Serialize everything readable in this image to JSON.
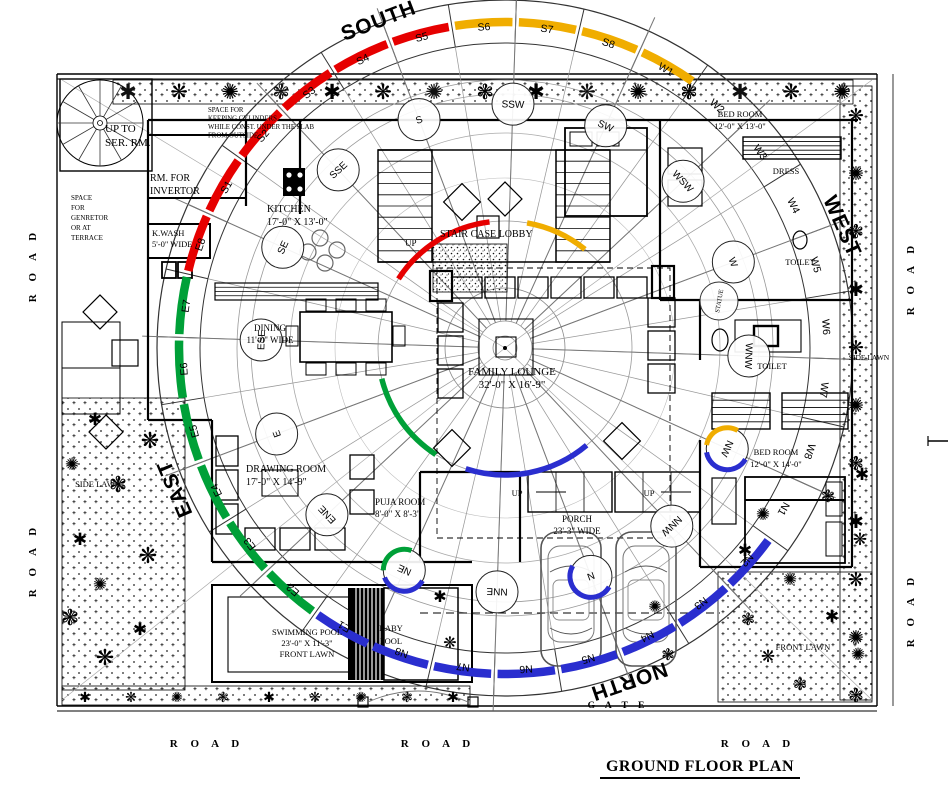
{
  "title": "GROUND FLOOR PLAN",
  "colors": {
    "red": "#e60000",
    "yellow": "#f0ad00",
    "green": "#00a038",
    "blue": "#2a2ecf",
    "wall": "#000000",
    "thin": "#888888"
  },
  "compass": {
    "big_directions": [
      {
        "label": "SOUTH",
        "x": 381,
        "y": 27,
        "rot": -21
      },
      {
        "label": "WEST",
        "x": 836,
        "y": 229,
        "rot": 66
      },
      {
        "label": "NORTH",
        "x": 627,
        "y": 675,
        "rot": 161
      },
      {
        "label": "EAST",
        "x": 181,
        "y": 486,
        "rot": -113
      }
    ],
    "direction_circles": [
      "S",
      "SSW",
      "SW",
      "WSW",
      "W",
      "WNW",
      "NW",
      "NNW",
      "N",
      "NNE",
      "NE",
      "ENE",
      "E",
      "ESE",
      "SE",
      "SSE"
    ],
    "circle_accents": {
      "NW": [
        "yellow",
        "blue"
      ],
      "N": [
        "blue"
      ],
      "NE": [
        "green",
        "blue"
      ]
    },
    "segments": [
      "S1",
      "S2",
      "S3",
      "S4",
      "S5",
      "S6",
      "S7",
      "S8",
      "W1",
      "W2",
      "W3",
      "W4",
      "W5",
      "W6",
      "W7",
      "W8",
      "N1",
      "N2",
      "N3",
      "N4",
      "N5",
      "N6",
      "N7",
      "N8",
      "E1",
      "E2",
      "E3",
      "E4",
      "E5",
      "E6",
      "E7",
      "E8"
    ],
    "segment_colors": [
      "red",
      "red",
      "red",
      "red",
      "red",
      "yellow",
      "yellow",
      "yellow",
      "yellow",
      "none",
      "none",
      "none",
      "none",
      "none",
      "none",
      "none",
      "none",
      "blue",
      "blue",
      "blue",
      "blue",
      "blue",
      "blue",
      "blue",
      "blue",
      "green",
      "green",
      "green",
      "green",
      "green",
      "green",
      "red"
    ],
    "statue": "STATUE"
  },
  "labels": [
    {
      "id": "up-to-ser-rm",
      "lines": [
        "UP TO",
        "SER. RM."
      ],
      "x": 105,
      "y": 132,
      "lh": 14,
      "size": 11,
      "anchor": "start"
    },
    {
      "id": "generator-note",
      "lines": [
        "SPACE",
        "FOR",
        "GENRETOR",
        "OR AT",
        "TERRACE"
      ],
      "x": 71,
      "y": 200,
      "lh": 10,
      "size": 7,
      "anchor": "start"
    },
    {
      "id": "rm-for-invertor",
      "lines": [
        "RM. FOR",
        "INVERTOR"
      ],
      "x": 150,
      "y": 181,
      "lh": 13,
      "size": 10,
      "anchor": "start"
    },
    {
      "id": "cylinders-note",
      "lines": [
        "SPACE FOR",
        "KEEPING CYLINDERS",
        "WHILE CONST. UNDER THE SLAB",
        "FROM OUTSIDE"
      ],
      "x": 208,
      "y": 112,
      "lh": 8.5,
      "size": 6.8,
      "anchor": "start"
    },
    {
      "id": "k-wash",
      "lines": [
        "K.WASH",
        "5'-0\" WIDE"
      ],
      "x": 152,
      "y": 236,
      "lh": 11,
      "size": 8.5,
      "anchor": "start"
    },
    {
      "id": "kitchen",
      "lines": [
        "KITCHEN",
        "17'-0\" X 13'-0\""
      ],
      "x": 267,
      "y": 212,
      "lh": 13,
      "size": 10,
      "anchor": "start"
    },
    {
      "id": "stair-case-lobby",
      "lines": [
        "STAIR CASE LOBBY"
      ],
      "x": 440,
      "y": 237,
      "lh": 12,
      "size": 10,
      "anchor": "start"
    },
    {
      "id": "up-stair",
      "lines": [
        "UP"
      ],
      "x": 405,
      "y": 246,
      "lh": 10,
      "size": 9,
      "anchor": "start"
    },
    {
      "id": "dining",
      "lines": [
        "DINING",
        "11'-0\" WIDE"
      ],
      "x": 270,
      "y": 331,
      "lh": 12,
      "size": 9,
      "anchor": "middle"
    },
    {
      "id": "family-lounge",
      "lines": [
        "FAMILY LOUNGE",
        "32'-0\" X 16'-9\""
      ],
      "x": 512,
      "y": 375,
      "lh": 13,
      "size": 11,
      "anchor": "middle"
    },
    {
      "id": "drawing-room",
      "lines": [
        "DRAWING ROOM",
        "17'-0\" X 14'-9\""
      ],
      "x": 246,
      "y": 472,
      "lh": 13,
      "size": 10,
      "anchor": "start"
    },
    {
      "id": "puja-room",
      "lines": [
        "PUJA ROOM",
        "8'-0\" X 8'-3\""
      ],
      "x": 375,
      "y": 505,
      "lh": 12,
      "size": 9,
      "anchor": "start"
    },
    {
      "id": "porch",
      "lines": [
        "PORCH",
        "23'-3\" WIDE"
      ],
      "x": 577,
      "y": 522,
      "lh": 12,
      "size": 9,
      "anchor": "middle"
    },
    {
      "id": "up-porch-left",
      "lines": [
        "UP"
      ],
      "x": 517,
      "y": 496,
      "lh": 10,
      "size": 8.5,
      "anchor": "middle"
    },
    {
      "id": "up-porch-right",
      "lines": [
        "UP"
      ],
      "x": 649,
      "y": 496,
      "lh": 10,
      "size": 8.5,
      "anchor": "middle"
    },
    {
      "id": "swimming-pool",
      "lines": [
        "SWIMMING POOL",
        "23'-0\" X 11'-3\"",
        "FRONT LAWN"
      ],
      "x": 307,
      "y": 635,
      "lh": 11,
      "size": 8.5,
      "anchor": "middle"
    },
    {
      "id": "baby-pool",
      "lines": [
        "BABY",
        "POOL"
      ],
      "x": 391,
      "y": 631,
      "lh": 13,
      "size": 8.5,
      "anchor": "middle"
    },
    {
      "id": "bed-room-top",
      "lines": [
        "BED ROOM",
        "12'-0\" X 13'-0\""
      ],
      "x": 740,
      "y": 117,
      "lh": 12,
      "size": 8.5,
      "anchor": "middle"
    },
    {
      "id": "dress",
      "lines": [
        "DRESS"
      ],
      "x": 786,
      "y": 174,
      "lh": 10,
      "size": 8.5,
      "anchor": "middle"
    },
    {
      "id": "toilet-1",
      "lines": [
        "TOILET"
      ],
      "x": 800,
      "y": 265,
      "lh": 10,
      "size": 8.5,
      "anchor": "middle"
    },
    {
      "id": "toilet-2",
      "lines": [
        "TOILET"
      ],
      "x": 772,
      "y": 369,
      "lh": 10,
      "size": 8.5,
      "anchor": "middle"
    },
    {
      "id": "bed-room-right",
      "lines": [
        "BED ROOM",
        "12'-0\" X 14'-0\""
      ],
      "x": 776,
      "y": 455,
      "lh": 12,
      "size": 8.5,
      "anchor": "middle"
    },
    {
      "id": "side-lawn-left",
      "lines": [
        "SIDE LAWN"
      ],
      "x": 98,
      "y": 487,
      "lh": 10,
      "size": 8.5,
      "anchor": "middle"
    },
    {
      "id": "side-lawn-right",
      "lines": [
        "SIDE LAWN"
      ],
      "x": 869,
      "y": 360,
      "lh": 10,
      "size": 7.5,
      "anchor": "middle"
    },
    {
      "id": "front-lawn",
      "lines": [
        "FRONT LAWN"
      ],
      "x": 803,
      "y": 650,
      "lh": 10,
      "size": 8.5,
      "anchor": "middle"
    }
  ],
  "roads": [
    {
      "text": "R  O  A  D",
      "x": 207,
      "y": 747,
      "rot": 0
    },
    {
      "text": "R  O  A  D",
      "x": 438,
      "y": 747,
      "rot": 0
    },
    {
      "text": "R  O  A  D",
      "x": 758,
      "y": 747,
      "rot": 0
    },
    {
      "text": "R  O  A  D",
      "x": 36,
      "y": 265,
      "rot": -90
    },
    {
      "text": "R  O  A  D",
      "x": 36,
      "y": 560,
      "rot": -90
    },
    {
      "text": "R  O  A  D",
      "x": 914,
      "y": 278,
      "rot": -90
    },
    {
      "text": "R  O  A  D",
      "x": 914,
      "y": 610,
      "rot": -90
    }
  ],
  "gate": {
    "text": "G  A  T  E",
    "x": 618,
    "y": 708
  }
}
